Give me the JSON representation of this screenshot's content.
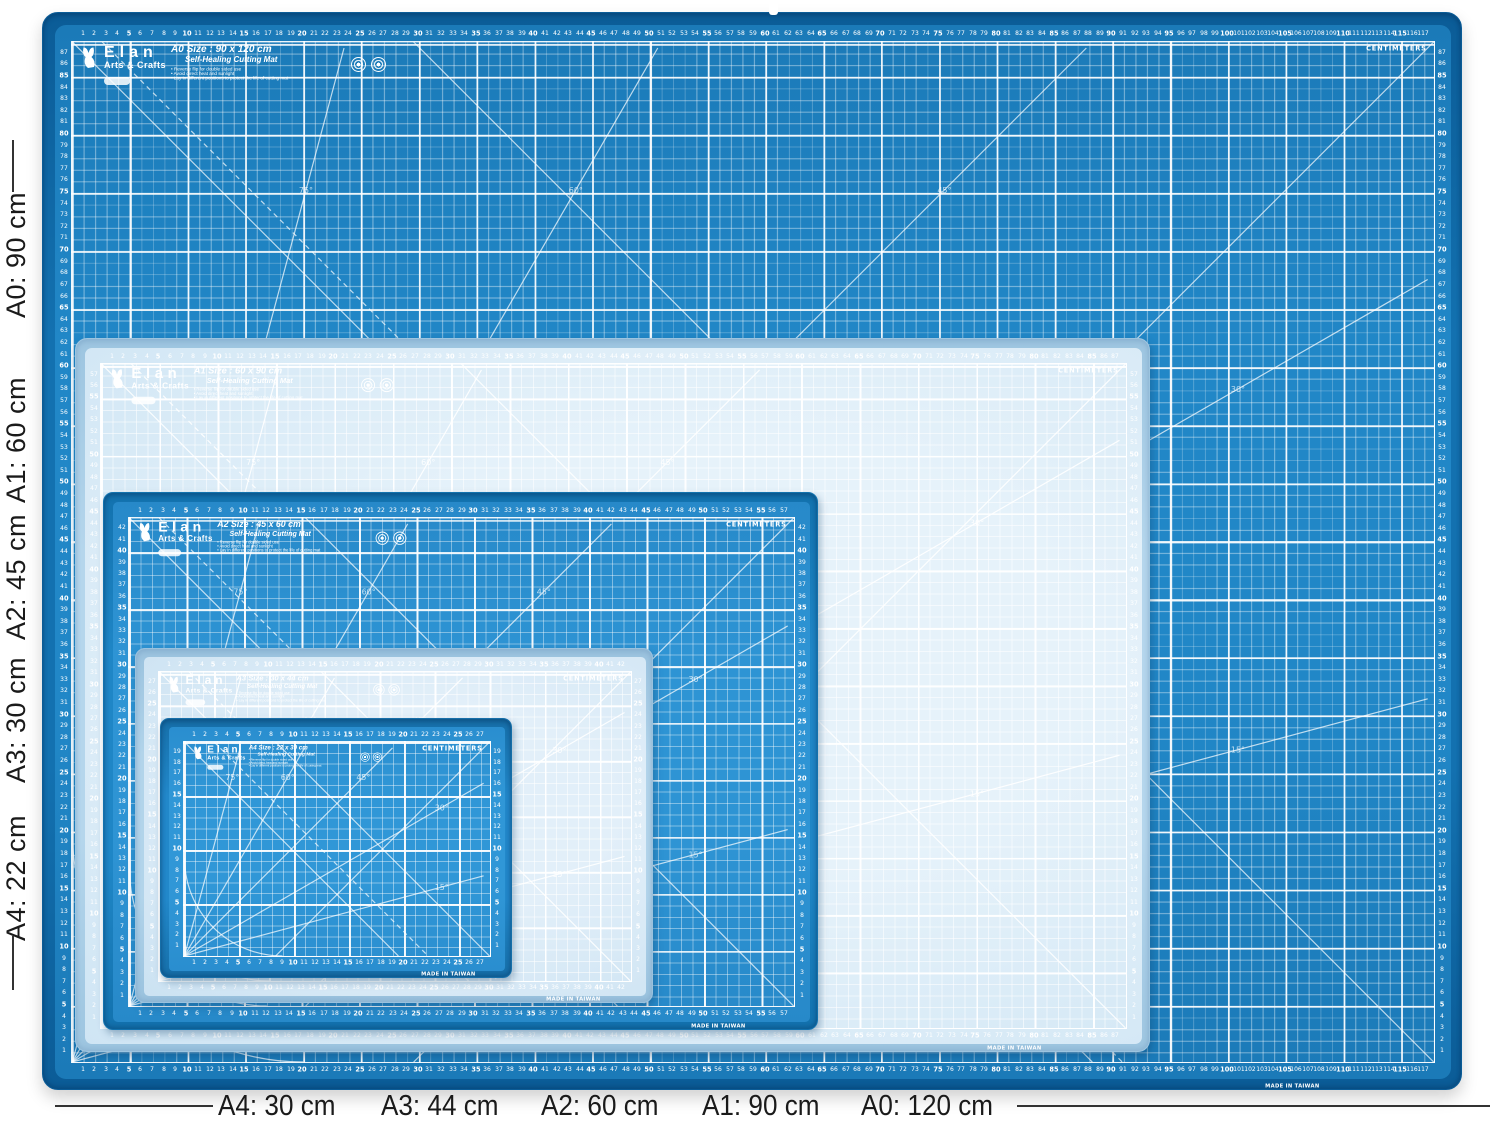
{
  "scene": {
    "background": "#ffffff"
  },
  "brand": {
    "name": "Elan",
    "division": "Arts & Crafts",
    "tagline": "Self-Healing Cutting Mat",
    "bullets": [
      "Reverse flip for double sided use",
      "Avoid direct heat and sunlight",
      "Lay in different positions to protect the life of cutting mat"
    ],
    "units_label": "CENTIMETERS",
    "made_in": "MADE IN TAIWAN"
  },
  "mats": [
    {
      "id": "a0",
      "name": "A0 cutting mat",
      "size_label": "A0 Size : 90 x 120 cm",
      "width_cm": 120,
      "height_cm": 90,
      "h_ruler_max": 117,
      "v_ruler_max": 87,
      "theme": "dark",
      "surface_color": "#2187c7",
      "surface_color2": "#1b7ab8",
      "edge_color": "#1371b0",
      "edge_dark": "#0b5c97",
      "line_major": "rgba(255,255,255,0.92)",
      "line_minor": "rgba(255,255,255,0.38)",
      "label_color": "#ffffff"
    },
    {
      "id": "a1",
      "name": "A1 cutting mat",
      "size_label": "A1 Size : 60 x 90 cm",
      "width_cm": 90,
      "height_cm": 60,
      "h_ruler_max": 87,
      "v_ruler_max": 57,
      "theme": "light",
      "surface_color": "#e6f2fa",
      "surface_color2": "#cfe5f4",
      "edge_color": "#b5d6ec",
      "edge_dark": "#9dc5e0",
      "line_major": "rgba(255,255,255,0.95)",
      "line_minor": "rgba(255,255,255,0.55)",
      "label_color": "#ffffff"
    },
    {
      "id": "a2",
      "name": "A2 cutting mat",
      "size_label": "A2 Size : 45 x 60 cm",
      "width_cm": 60,
      "height_cm": 45,
      "h_ruler_max": 57,
      "v_ruler_max": 42,
      "theme": "dark",
      "surface_color": "#2e94d4",
      "surface_color2": "#2789c9",
      "edge_color": "#1f86c6",
      "edge_dark": "#1372ae",
      "line_major": "rgba(255,255,255,0.92)",
      "line_minor": "rgba(255,255,255,0.40)",
      "label_color": "#ffffff"
    },
    {
      "id": "a3",
      "name": "A3 cutting mat",
      "size_label": "A3 Size : 30 x 44 cm",
      "width_cm": 44,
      "height_cm": 30,
      "h_ruler_max": 42,
      "v_ruler_max": 27,
      "theme": "light",
      "surface_color": "#e2eff9",
      "surface_color2": "#cbe2f2",
      "edge_color": "#b2d4ea",
      "edge_dark": "#9ac2de",
      "line_major": "rgba(255,255,255,0.95)",
      "line_minor": "rgba(255,255,255,0.55)",
      "label_color": "#ffffff"
    },
    {
      "id": "a4",
      "name": "A4 cutting mat",
      "size_label": "A4 Size : 22 x 30 cm",
      "width_cm": 30,
      "height_cm": 22,
      "h_ruler_max": 27,
      "v_ruler_max": 19,
      "theme": "dark",
      "surface_color": "#3097d7",
      "surface_color2": "#2a8ecf",
      "edge_color": "#2288ca",
      "edge_dark": "#166fa9",
      "line_major": "rgba(255,255,255,0.92)",
      "line_minor": "rgba(255,255,255,0.42)",
      "label_color": "#ffffff"
    }
  ],
  "angle_labels": [
    "75°",
    "60°",
    "45°",
    "30°",
    "15°"
  ],
  "dimension_annotations": {
    "left_labels": [
      {
        "label": "A0: 90 cm"
      },
      {
        "label": "A1: 60 cm"
      },
      {
        "label": "A2: 45 cm"
      },
      {
        "label": "A3: 30 cm"
      },
      {
        "label": "A4: 22 cm"
      }
    ],
    "bottom_labels": [
      {
        "label": "A4: 30 cm"
      },
      {
        "label": "A3: 44 cm"
      },
      {
        "label": "A2: 60 cm"
      },
      {
        "label": "A1: 90 cm"
      },
      {
        "label": "A0: 120 cm"
      }
    ],
    "line_color": "#333333",
    "text_color": "#1a1a1a"
  }
}
